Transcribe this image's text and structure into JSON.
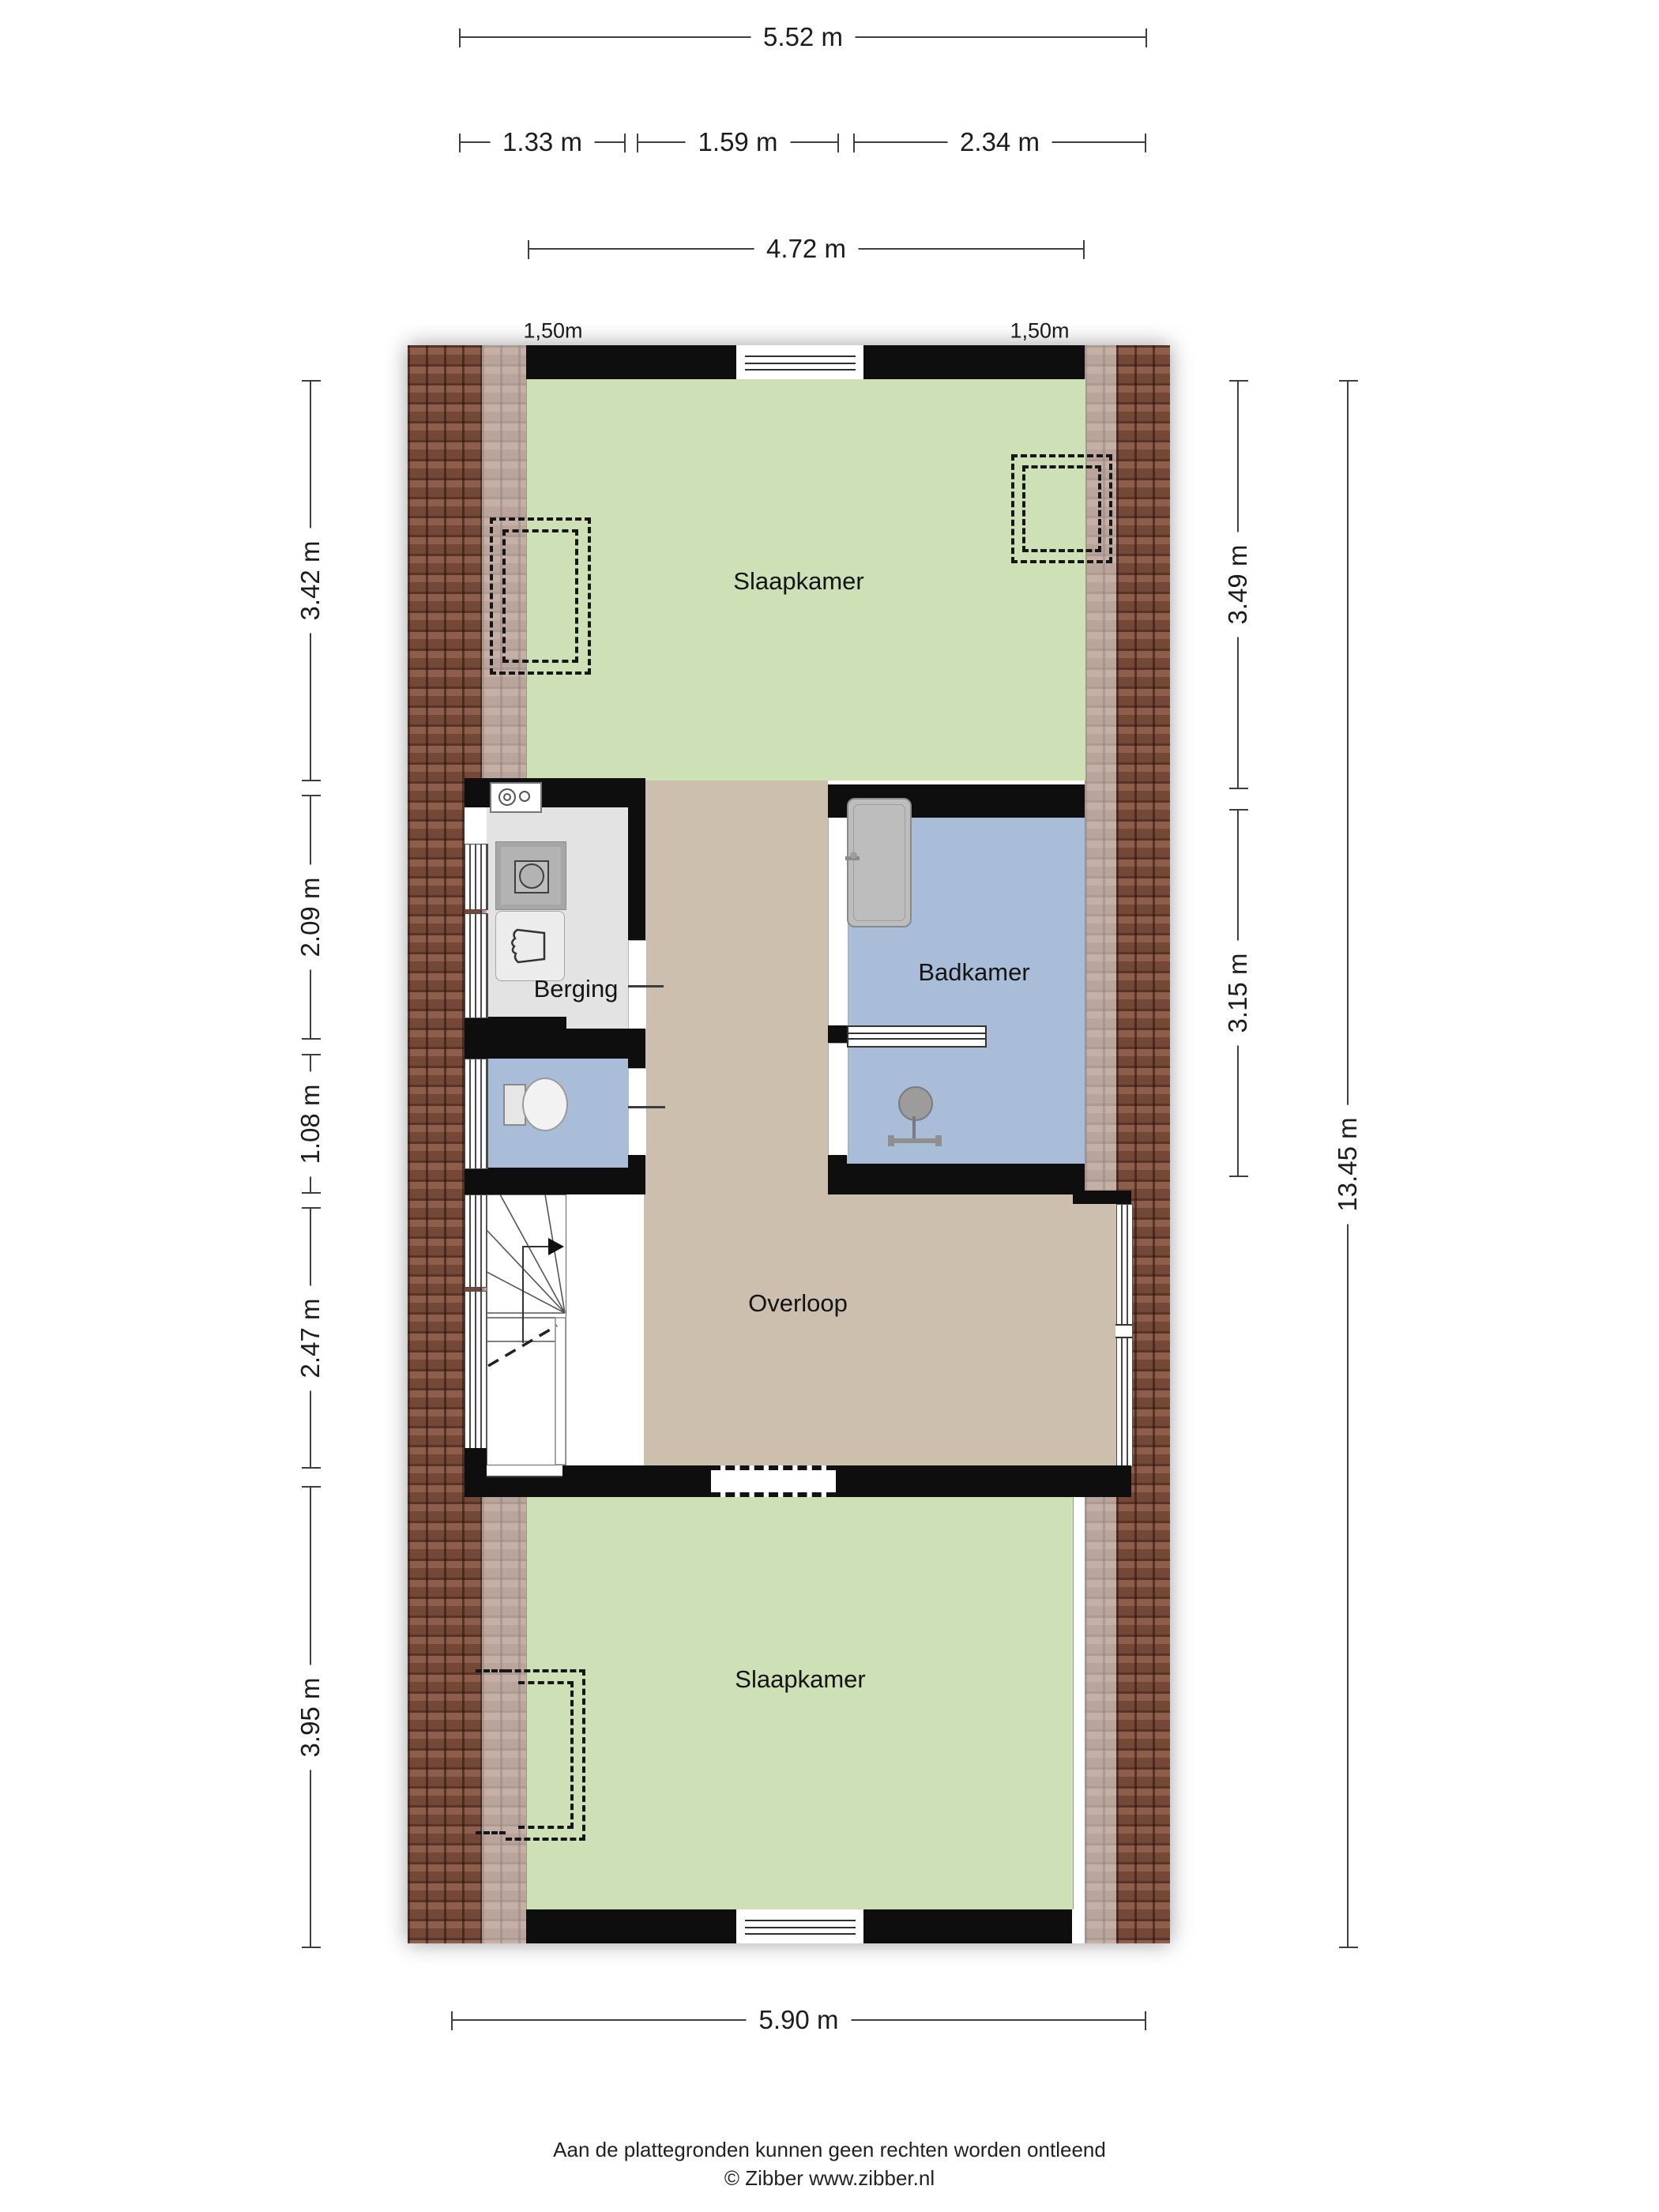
{
  "plan_type": "floor-plan",
  "rooms": {
    "bedroom_top": "Slaapkamer",
    "storage": "Berging",
    "bathroom": "Badkamer",
    "landing": "Overloop",
    "bedroom_bottom": "Slaapkamer"
  },
  "dimensions": {
    "top_total": "5.52 m",
    "top_segments": [
      "1.33 m",
      "1.59 m",
      "2.34 m"
    ],
    "top_inner": "4.72 m",
    "height_left": "1,50m",
    "height_right": "1,50m",
    "left": [
      "3.42 m",
      "2.09 m",
      "1.08 m",
      "2.47 m",
      "3.95 m"
    ],
    "right": [
      "3.49 m",
      "3.15 m"
    ],
    "right_total": "13.45 m",
    "bottom": "5.90 m"
  },
  "footer": {
    "line1": "Aan de plattegronden kunnen geen rechten worden ontleend",
    "line2": "© Zibber www.zibber.nl"
  },
  "icons": {
    "washing_machine": "washing-machine-icon",
    "washer_connection": "washer-connection-icon",
    "laundry_basket": "laundry-basket-icon",
    "toilet": "toilet-icon",
    "door_leaf": "door-leaf-icon",
    "radiator": "radiator-icon",
    "shower_drain": "shower-drain-icon",
    "shower_faucet": "shower-faucet-icon",
    "stairs": "stairs-icon",
    "window": "window-icon",
    "dormer_dashed": "dormer-dashed-outline"
  },
  "colors": {
    "bedroom_green": "#cde0b6",
    "landing_tan": "#cdbfad",
    "bathroom_blue": "#a9bdd8",
    "storage_gray": "#e3e3e3",
    "wall_black": "#0e0e0e",
    "brick_dark": "#84523f",
    "dimension_line": "#3f3f3f"
  }
}
